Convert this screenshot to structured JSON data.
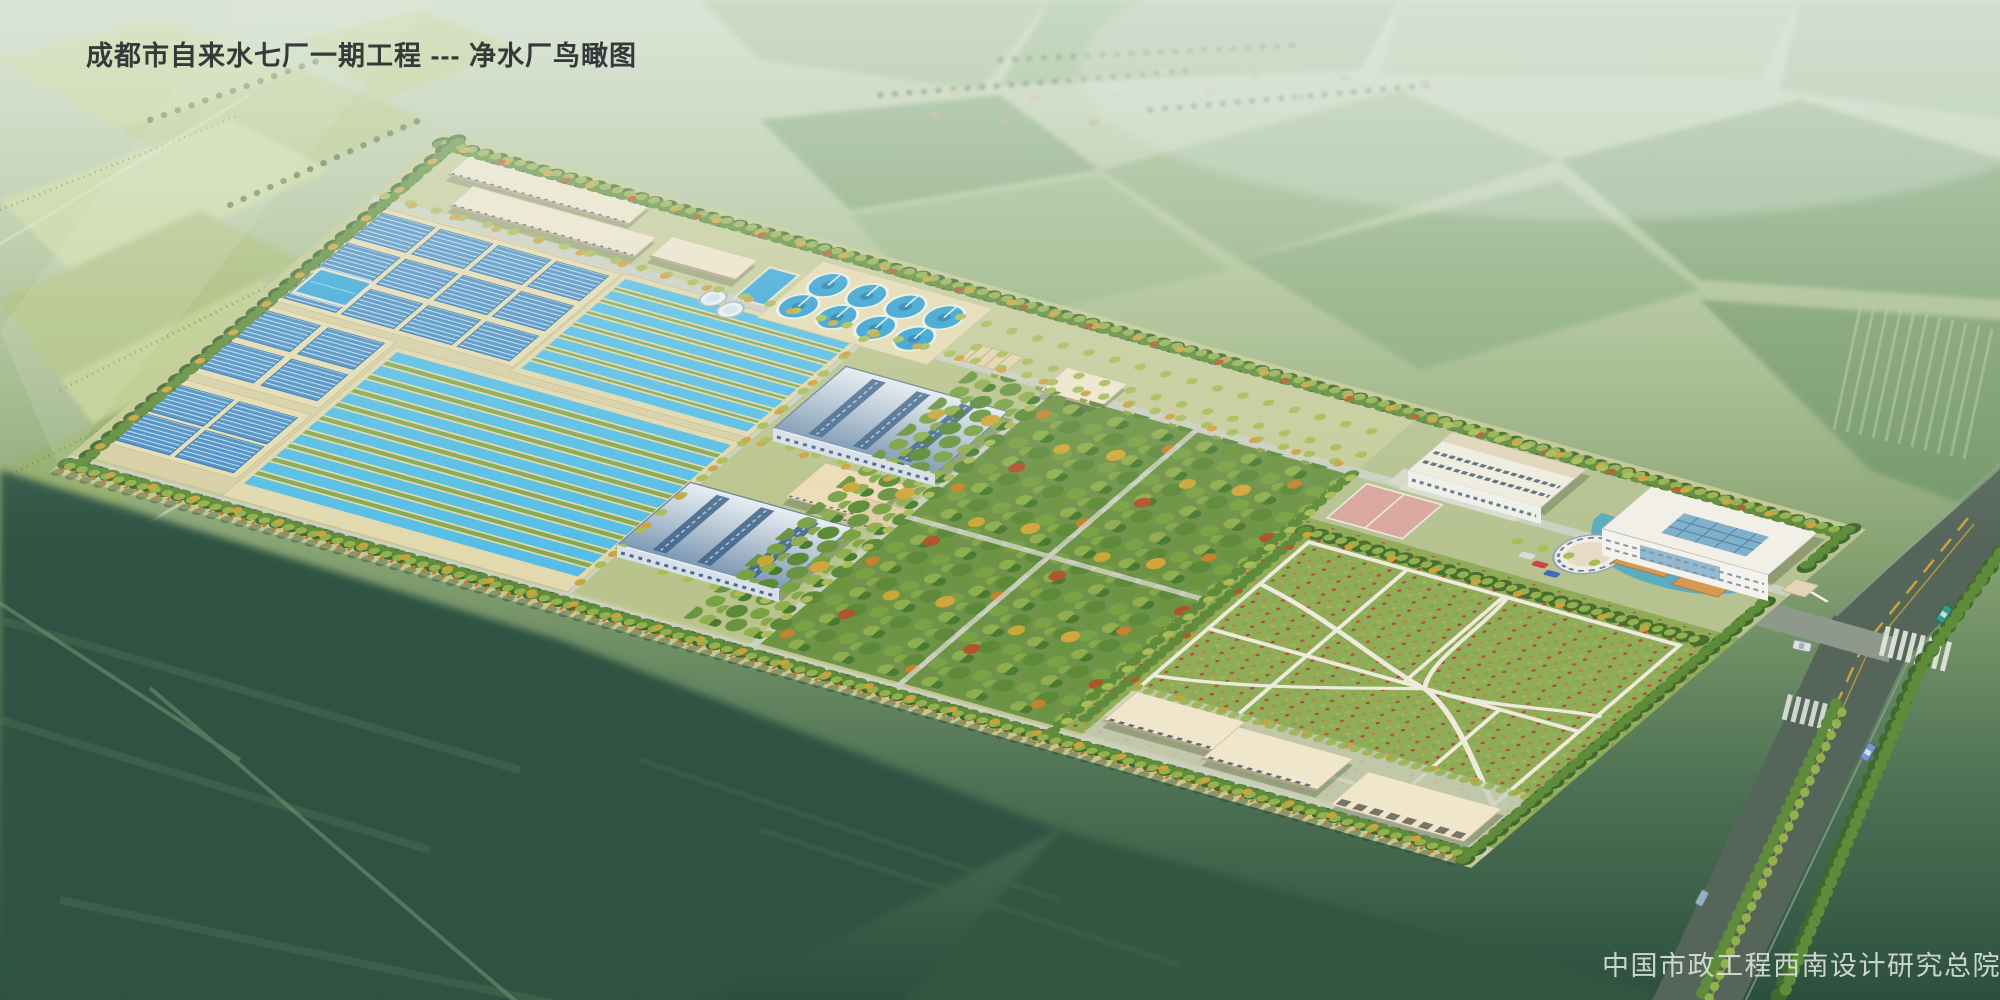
{
  "title": {
    "text": "成都市自来水七厂一期工程 --- 净水厂鸟瞰图"
  },
  "credit": {
    "text": "中国市政工程西南设计研究总院"
  },
  "palette": {
    "haze": "#dfe9dc",
    "field_light": "#c7d18e",
    "field_dark": "#2e5242",
    "site_ground": "#d8d0a4",
    "basin_water": "#56bee6",
    "filter_cover_blue": "#4a8ec6",
    "clarifier_water": "#2f9fd2",
    "arch_roof_blue": "#8fa8c2",
    "roof_beige": "#f0e6cc",
    "orchard_green": "#6f9348",
    "flower_field_green": "#8fac58",
    "flower_red": "#bf4a2e",
    "tree_green": "#5f8c3a",
    "tree_autumn": "#cda23c",
    "asphalt": "#55655a",
    "lane_marking_yellow": "#c8a23c"
  }
}
